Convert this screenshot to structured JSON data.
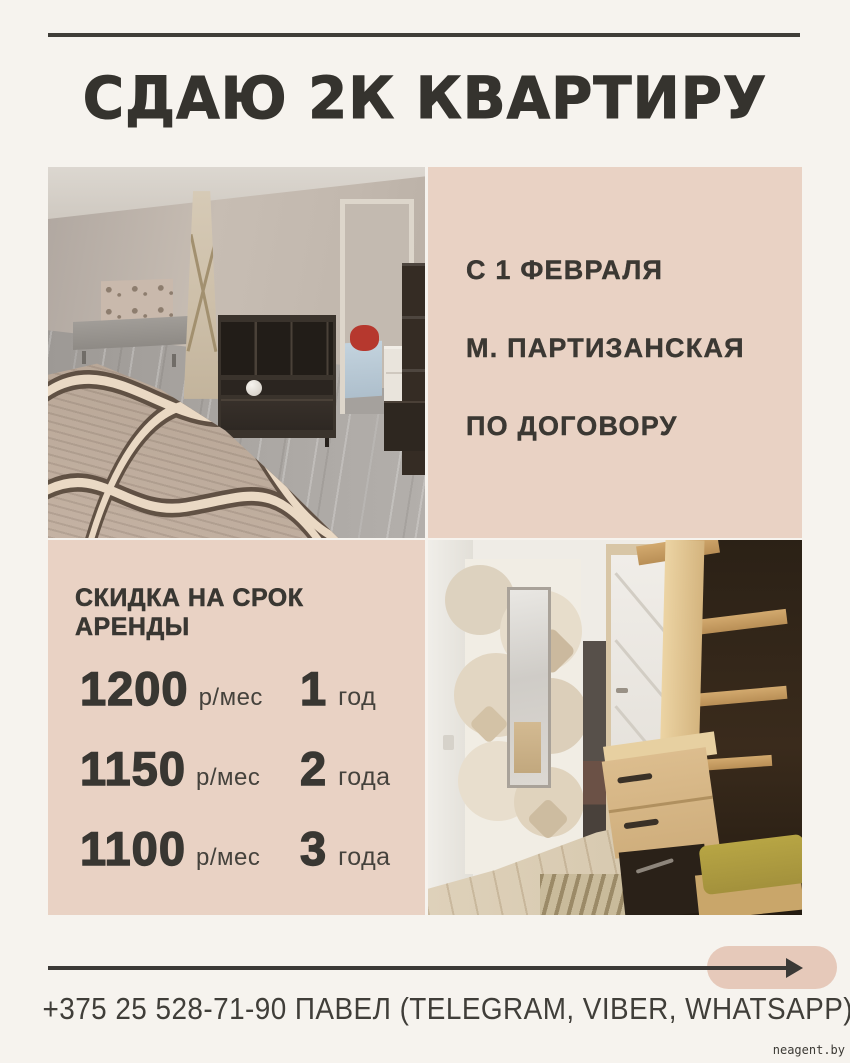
{
  "title": "СДАЮ 2К КВАРТИРУ",
  "info_panel": {
    "line1": "С 1 ФЕВРАЛЯ",
    "line2": "М. ПАРТИЗАНСКАЯ",
    "line3": "ПО ДОГОВОРУ"
  },
  "discounts": {
    "heading": "СКИДКА НА СРОК АРЕНДЫ",
    "rows": [
      {
        "price": "1200",
        "unit": "р/мес",
        "term_value": "1",
        "term_label": "год"
      },
      {
        "price": "1150",
        "unit": "р/мес",
        "term_value": "2",
        "term_label": "года"
      },
      {
        "price": "1100",
        "unit": "р/мес",
        "term_value": "3",
        "term_label": "года"
      }
    ]
  },
  "footer": {
    "contact_line": "+375 25 528-71-90 ПАВЕЛ (TELEGRAM, VIBER, WHATSAPP)"
  },
  "watermark": "neagent.by",
  "colors": {
    "background": "#f6f3ee",
    "panel_beige": "#e9d2c4",
    "ink": "#3a3833",
    "pill_beige": "#e6c9ba",
    "bench_olive": "#b7a544"
  }
}
